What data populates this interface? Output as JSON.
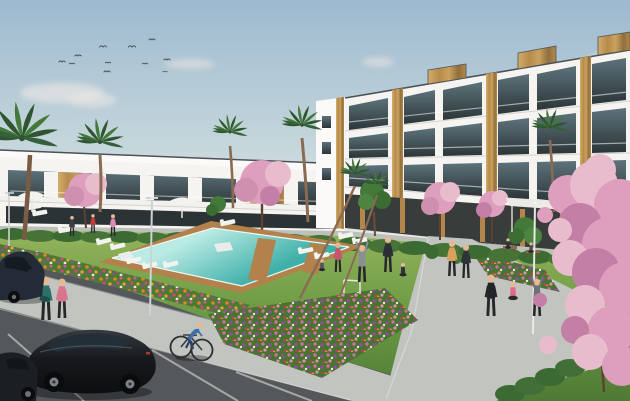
{
  "meta": {
    "title": "Architectural rendering of a modern residential complex with communal pool and gardens",
    "render_type": "exterior CGI visualization",
    "canvas": "630x401"
  },
  "palette": {
    "sky_top": "#9db9cf",
    "sky_mid": "#c6d7dc",
    "sky_horizon": "#e6eae7",
    "cloud_white": "#efe9e4",
    "building_white": "#f5f4f1",
    "building_bright": "#fbfaf8",
    "fascia_shadow": "#d6d3cd",
    "roof_edge": "#4d5257",
    "glass_sky": "#5d727b",
    "glass_dark": "#2c3638",
    "wood_light": "#d3ad6a",
    "wood_mid": "#b68a4b",
    "wood_dark": "#8f6f3e",
    "grass_light": "#96b55e",
    "grass_mid": "#6f9d46",
    "grass_dark": "#4f7a34",
    "hedge_green": "#3c6a33",
    "tree_green": "#437a3a",
    "palm_green": "#2f5530",
    "palm_green_light": "#437a3a",
    "bed_green": "#4c7a33",
    "pool_far": "#b9ebe4",
    "pool_near": "#3fb0a9",
    "deck_wood": "#b2814c",
    "path_light": "#c2c4c0",
    "asphalt": "#54585b",
    "line_white": "#e9eae6",
    "car_black": "#17191c",
    "car_glass": "#232e36",
    "sedan_body": "#242b36",
    "blossom_light": "#f2c9d8",
    "blossom_mid": "#dd9fbd",
    "blossom_deep": "#c47fa6",
    "branch_brown": "#5c4033",
    "trunk_brown": "#8a6b52",
    "flower_orange": "#e0812f",
    "flower_magenta": "#cd5f95",
    "flower_purple": "#8e4d9e",
    "skin": "#e5b896"
  },
  "scene": {
    "sky": {
      "birds": 11,
      "clouds": 5
    },
    "buildings": {
      "left_row_stories": 2,
      "right_block_stories": 3,
      "style": "white contemporary apartments with glass balustrades and vertical wood-slat accents",
      "rooftop_wood_boxes": 3
    },
    "landscape": {
      "palm_trees": 7,
      "blossom_trees": 5,
      "ornamental_green_trees": 3,
      "flower_beds": 3,
      "hedge_rows": 2,
      "lawn": true
    },
    "pool": {
      "water_color_name": "turquoise",
      "wood_deck": true,
      "sun_loungers": 13,
      "parasols": 2,
      "shade_sails": 1
    },
    "people": {
      "total": 18,
      "activities": [
        "walking",
        "jogging",
        "cycling",
        "yoga",
        "stretching",
        "sitting on benches"
      ]
    },
    "vehicles": {
      "parked_cars": 3,
      "bicycles": 1
    },
    "ground": {
      "pedestrian_paths": 2,
      "parking_lot": true,
      "parking_stall_lines": 3,
      "street_lamps": 2,
      "flag_pole": 1
    }
  }
}
